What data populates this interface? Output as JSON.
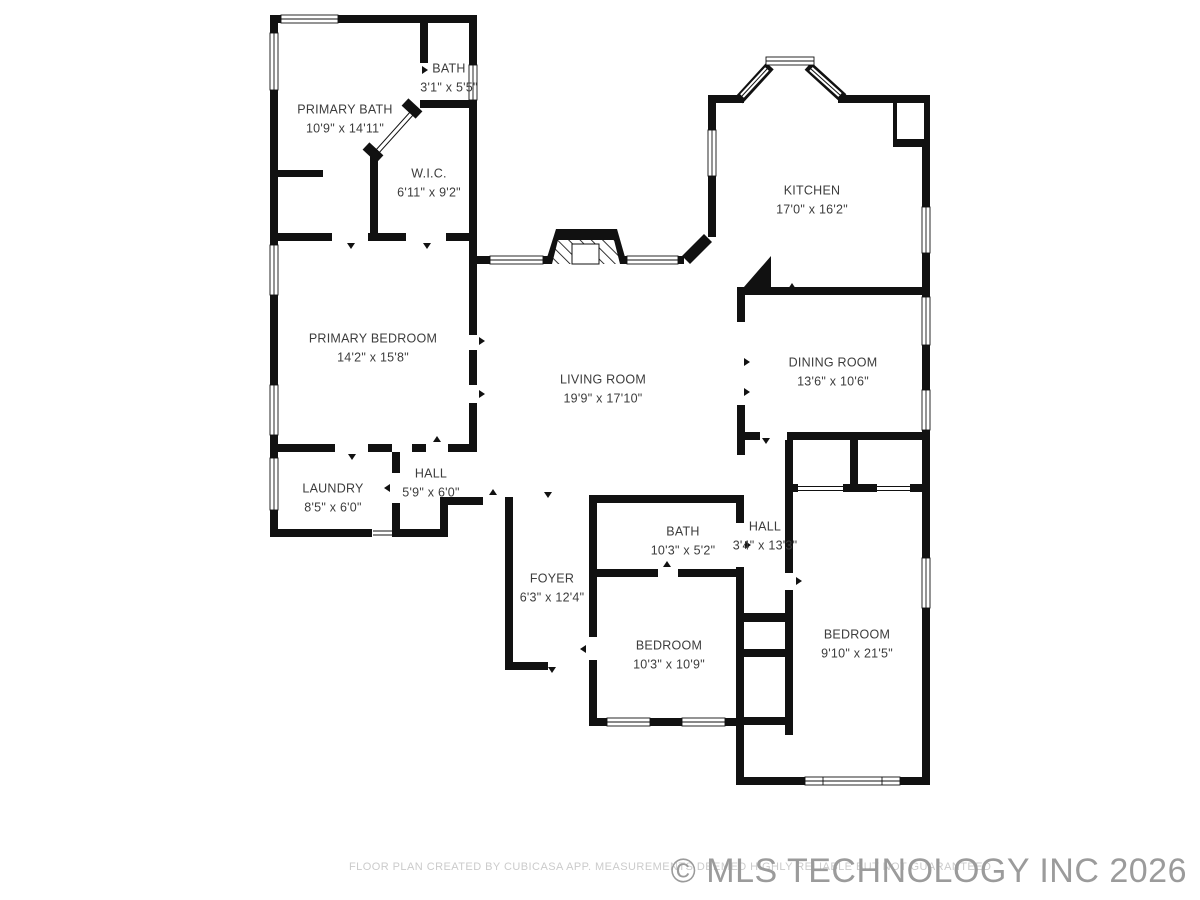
{
  "floor_plan": {
    "rooms": [
      {
        "id": "primary-bath",
        "name": "PRIMARY BATH",
        "dims": "10'9\" x 14'11\""
      },
      {
        "id": "bath-small",
        "name": "BATH",
        "dims": "3'1\" x 5'5\""
      },
      {
        "id": "wic",
        "name": "W.I.C.",
        "dims": "6'11\" x 9'2\""
      },
      {
        "id": "kitchen",
        "name": "KITCHEN",
        "dims": "17'0\" x 16'2\""
      },
      {
        "id": "primary-bedroom",
        "name": "PRIMARY BEDROOM",
        "dims": "14'2\" x 15'8\""
      },
      {
        "id": "living-room",
        "name": "LIVING ROOM",
        "dims": "19'9\" x 17'10\""
      },
      {
        "id": "dining-room",
        "name": "DINING ROOM",
        "dims": "13'6\" x 10'6\""
      },
      {
        "id": "laundry",
        "name": "LAUNDRY",
        "dims": "8'5\" x 6'0\""
      },
      {
        "id": "hall-west",
        "name": "HALL",
        "dims": "5'9\" x 6'0\""
      },
      {
        "id": "bath-hall",
        "name": "BATH",
        "dims": "10'3\" x 5'2\""
      },
      {
        "id": "hall-east",
        "name": "HALL",
        "dims": "3'4\" x 13'3\""
      },
      {
        "id": "foyer",
        "name": "FOYER",
        "dims": "6'3\" x 12'4\""
      },
      {
        "id": "bedroom-front",
        "name": "BEDROOM",
        "dims": "10'3\" x 10'9\""
      },
      {
        "id": "bedroom-rear",
        "name": "BEDROOM",
        "dims": "9'10\" x 21'5\""
      }
    ],
    "footer": "FLOOR PLAN CREATED BY CUBICASA APP. MEASUREMENTS DEEMED HIGHLY RELIABLE BUT NOT GUARANTEED",
    "watermark": "© MLS TECHNOLOGY INC 2026",
    "colors": {
      "wall": "#111111",
      "label_text": "#3c3c3c",
      "footer_text": "#cbcbcb",
      "watermark_text": "#9b9b9b",
      "background": "#ffffff"
    }
  }
}
